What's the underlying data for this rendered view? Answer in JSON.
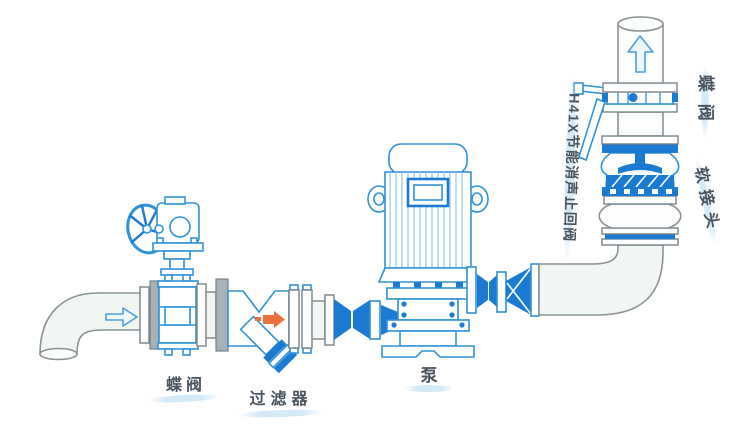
{
  "diagram": {
    "labels": {
      "inlet_butterfly_valve": "蝶阀",
      "strainer": "过滤器",
      "pump": "泵",
      "check_valve": "H41X节能消声止回阀",
      "outlet_butterfly_valve": "蝶阀",
      "flexible_joint": "软接头"
    },
    "icons": {
      "inlet_flow_arrow": "right-arrow",
      "strainer_flow_arrow": "right-arrow",
      "outlet_flow_arrow": "up-arrow"
    },
    "colors": {
      "equipment_blue": "#2f93d6",
      "solid_blue": "#1b7ad2",
      "fin_blue": "#8fc9ee",
      "pipe_outline": "#8a9298",
      "pipe_fill": "#f1f6f3",
      "flange_gray": "#a7b2b8",
      "flange_outline": "#75828a",
      "label_text": "#4a5560",
      "label_swoosh": "#d5eaf7",
      "orange": "#e8713c",
      "bg": "#ffffff"
    }
  }
}
